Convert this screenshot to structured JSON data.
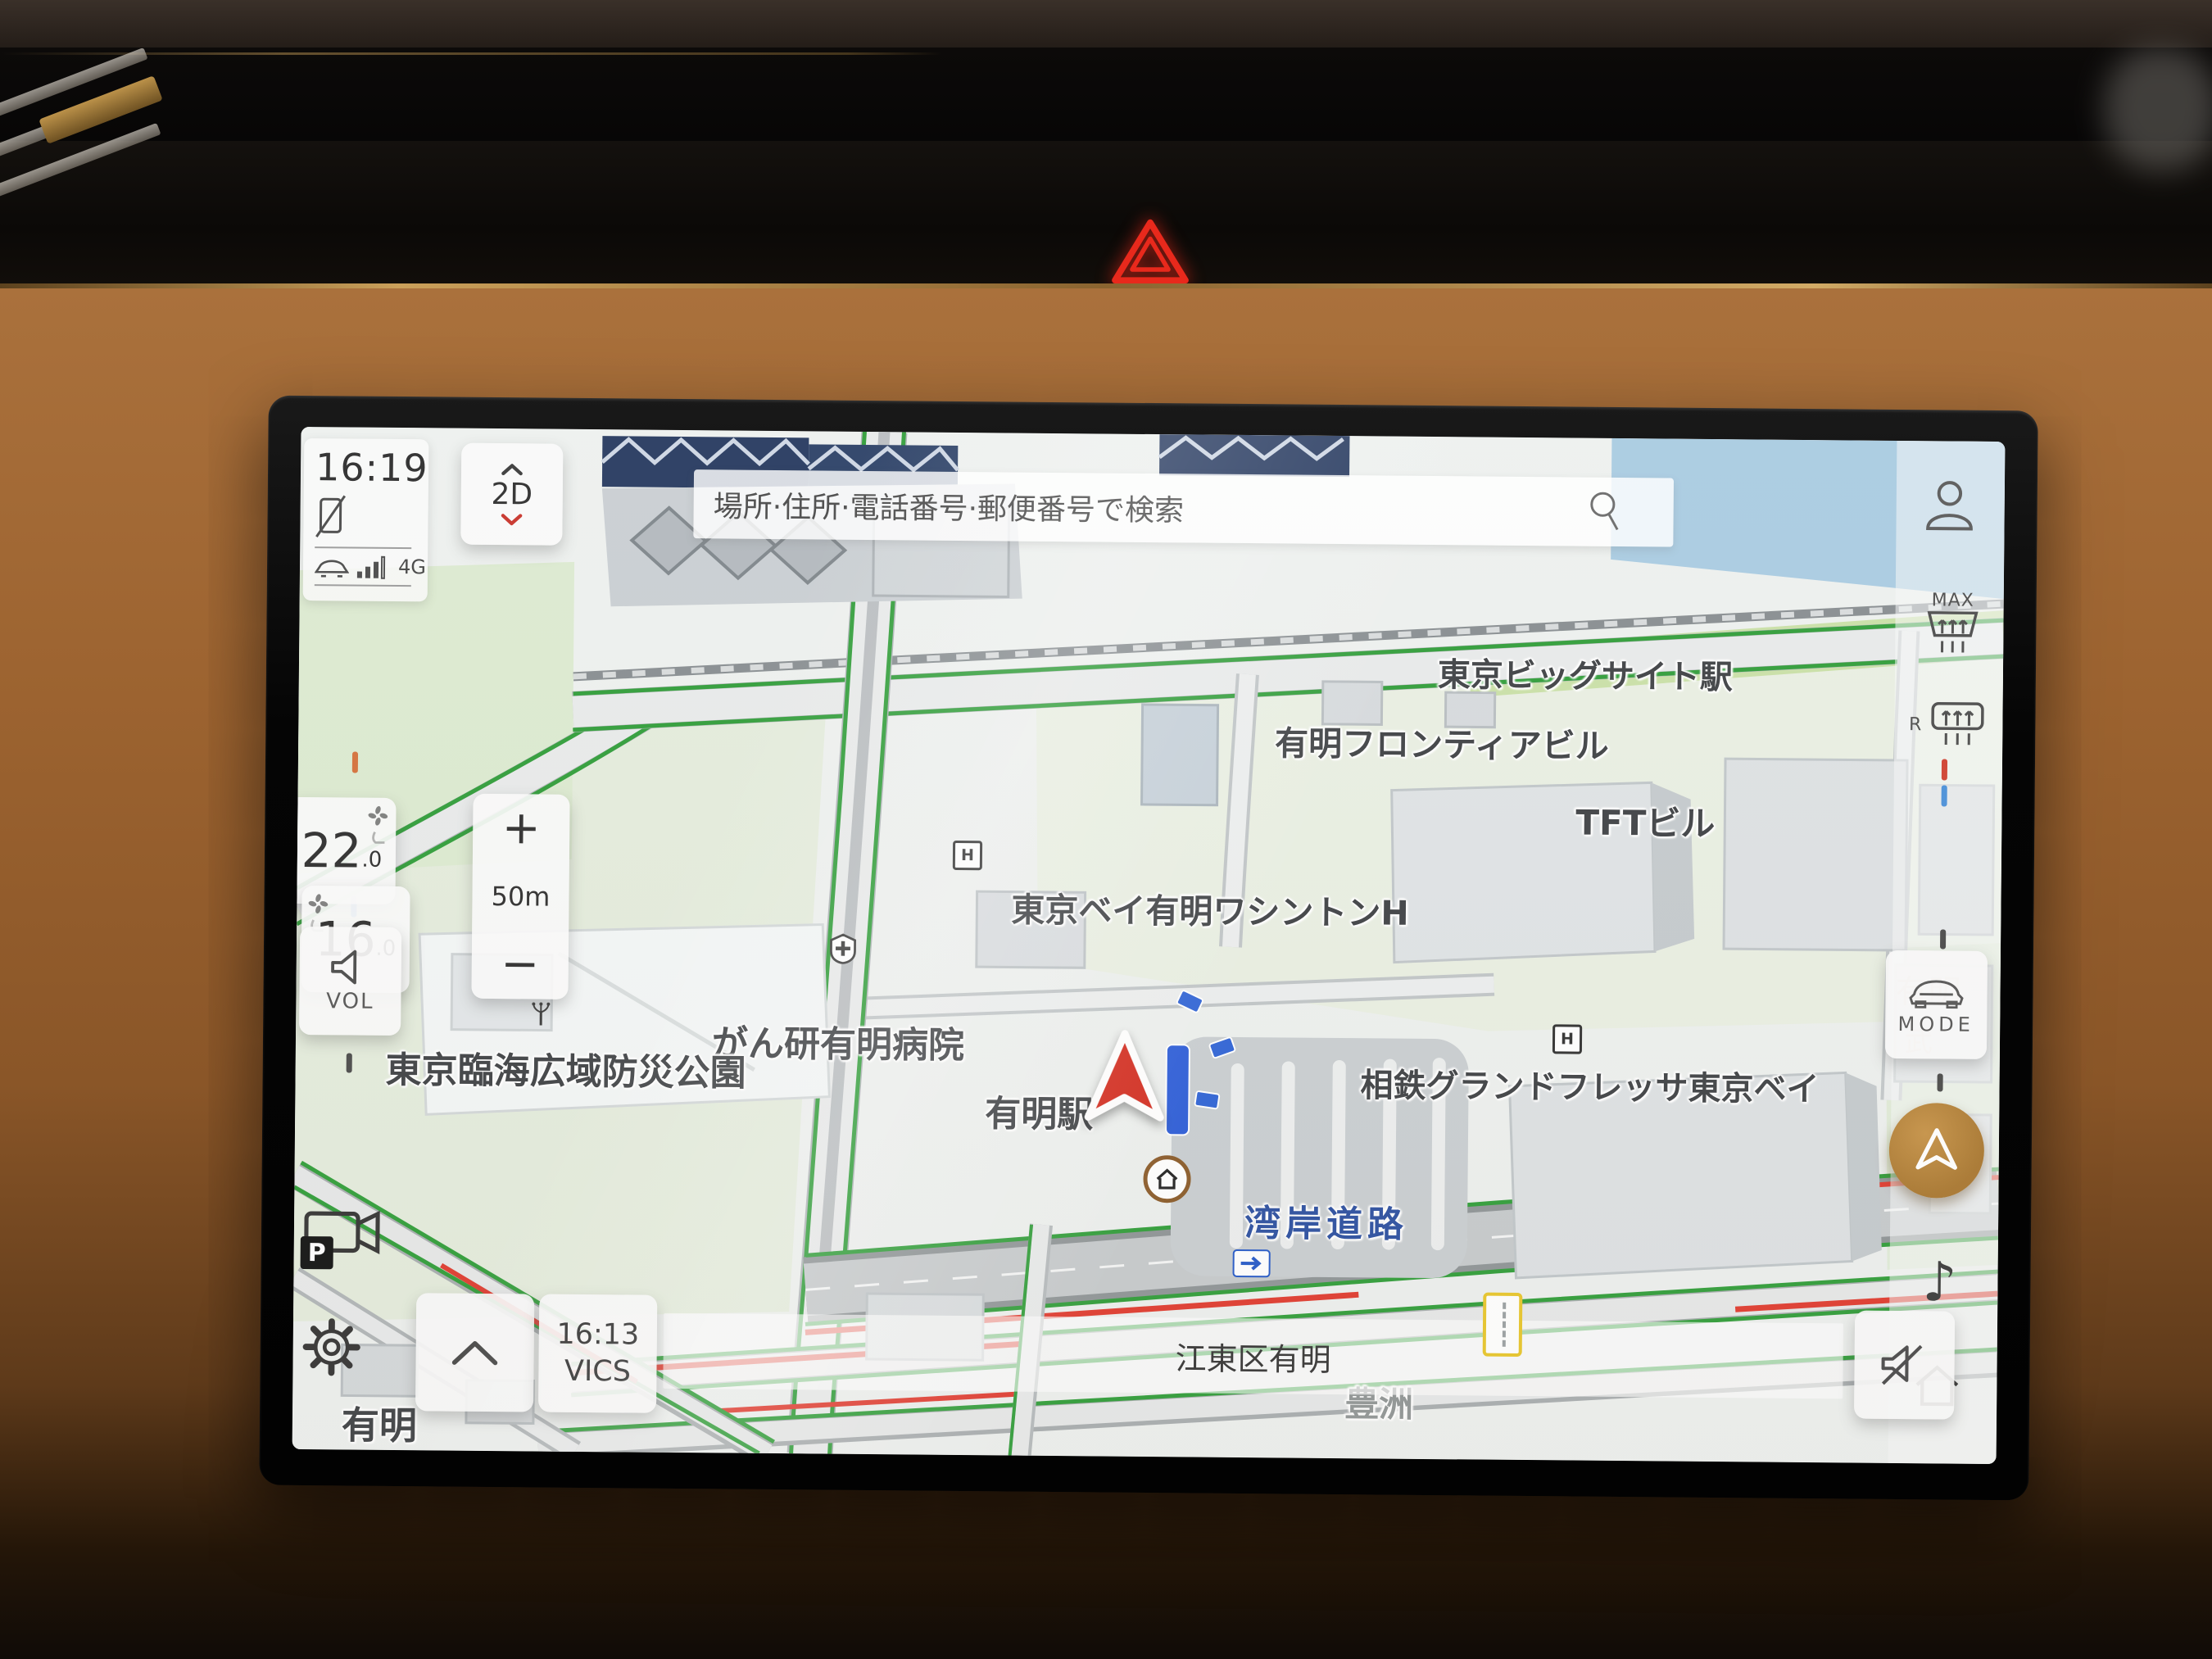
{
  "colors": {
    "accent_gold": "#b9863b",
    "traffic_green": "#2f9d38",
    "traffic_red": "#e03a2e",
    "water": "#a9cbe1",
    "park_green": "#e4ecdc",
    "road_fill": "#e8eaea",
    "label_dark": "#3e4144",
    "road_label_blue": "#2b4fa0",
    "nav_arrow_red": "#d32b1e"
  },
  "status": {
    "clock": "16:19",
    "network": "4G"
  },
  "map_controls": {
    "view": "2D",
    "zoom_in": "+",
    "zoom_out": "−",
    "scale": "50m"
  },
  "search": {
    "placeholder": "場所·住所·電話番号·郵便番号で検索"
  },
  "climate": {
    "driver_temp": "16",
    "driver_temp_dec": ".0",
    "passenger_temp": "22",
    "passenger_temp_dec": ".0"
  },
  "buttons": {
    "volume": "VOL",
    "mode": "MODE",
    "defrost_front": "MAX",
    "defrost_rear": "R",
    "camera_badge": "P",
    "music_note": "♪"
  },
  "traffic_info": {
    "vics_time": "16:13",
    "vics": "VICS"
  },
  "location_bar": {
    "current_area": "江東区有明"
  },
  "map_labels": {
    "big_sight_station": "東京ビッグサイト駅",
    "ariake_frontier_bldg": "有明フロンティアビル",
    "tft_bldg": "TFTビル",
    "washington_hotel": "東京ベイ有明ワシントンH",
    "ganken_ariake_hospital": "がん研有明病院",
    "rinkai_disaster_park": "東京臨海広域防災公園",
    "ariake_station": "有明駅",
    "wangan_road": "湾岸道路",
    "sotetsu_grand_fresa": "相鉄グランドフレッサ東京ベイ",
    "ariake_district_faint": "有明",
    "take_faint": "武",
    "toyosu_faint": "豊洲",
    "ariake_bottom": "有明",
    "hotel_marker": "H"
  }
}
